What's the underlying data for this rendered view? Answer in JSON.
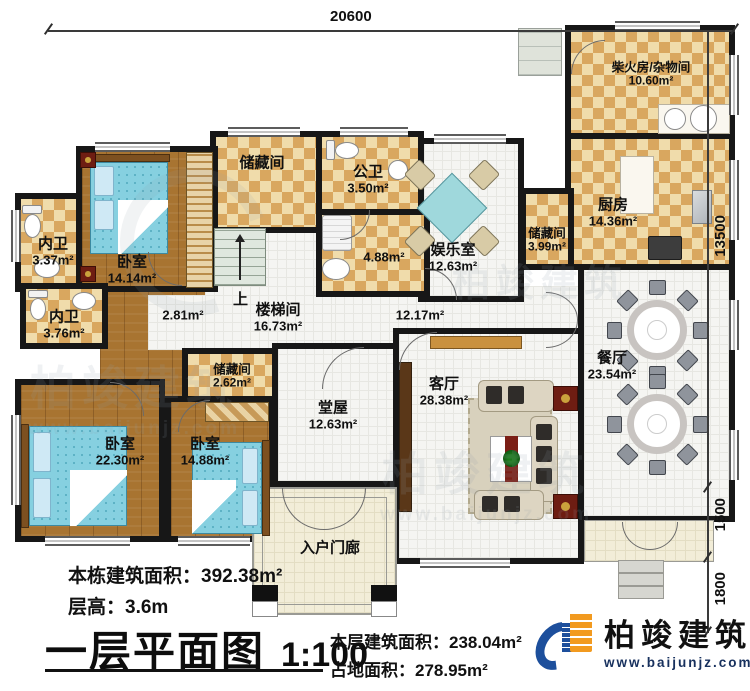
{
  "dimensions": {
    "top": "20600",
    "right_top": "13500",
    "right_mid": "1500",
    "right_bottom": "1800"
  },
  "rooms": {
    "firewood": {
      "name": "柴火房/杂物间",
      "area": "10.60m²"
    },
    "kitchen": {
      "name": "厨房",
      "area": "14.36m²"
    },
    "storage_kitchen": {
      "name": "储藏间",
      "area": "3.99m²"
    },
    "dining": {
      "name": "餐厅",
      "area": "23.54m²"
    },
    "entertainment": {
      "name": "娱乐室",
      "area": "12.63m²"
    },
    "public_bath": {
      "name": "公卫",
      "area": "3.50m²"
    },
    "bath_488": {
      "area": "4.88m²"
    },
    "storage_top": {
      "name": "储藏间"
    },
    "stairwell": {
      "name": "楼梯间",
      "area": "16.73m²",
      "up": "上"
    },
    "hall_281": {
      "area": "2.81m²"
    },
    "hall_1217": {
      "area": "12.17m²"
    },
    "bath_337": {
      "name": "内卫",
      "area": "3.37m²"
    },
    "bedroom_1414": {
      "name": "卧室",
      "area": "14.14m²"
    },
    "bath_376": {
      "name": "内卫",
      "area": "3.76m²"
    },
    "storage_262": {
      "name": "储藏间",
      "area": "2.62m²"
    },
    "bedroom_2230": {
      "name": "卧室",
      "area": "22.30m²"
    },
    "bedroom_1488": {
      "name": "卧室",
      "area": "14.88m²"
    },
    "main_hall": {
      "name": "堂屋",
      "area": "12.63m²"
    },
    "living": {
      "name": "客厅",
      "area": "28.38m²"
    },
    "porch": {
      "name": "入户门廊"
    }
  },
  "stats": {
    "building_area_label": "本栋建筑面积：",
    "building_area_value": "392.38m²",
    "floor_height_label": "层高：",
    "floor_height_value": "3.6m",
    "floor_area_label": "本层建筑面积：",
    "floor_area_value": "238.04m²",
    "land_area_label": "占地面积：",
    "land_area_value": "278.95m²"
  },
  "title": {
    "text": "一层平面图",
    "scale": "1:100"
  },
  "branding": {
    "name": "柏竣建筑",
    "url": "www.baijunjz.com"
  }
}
